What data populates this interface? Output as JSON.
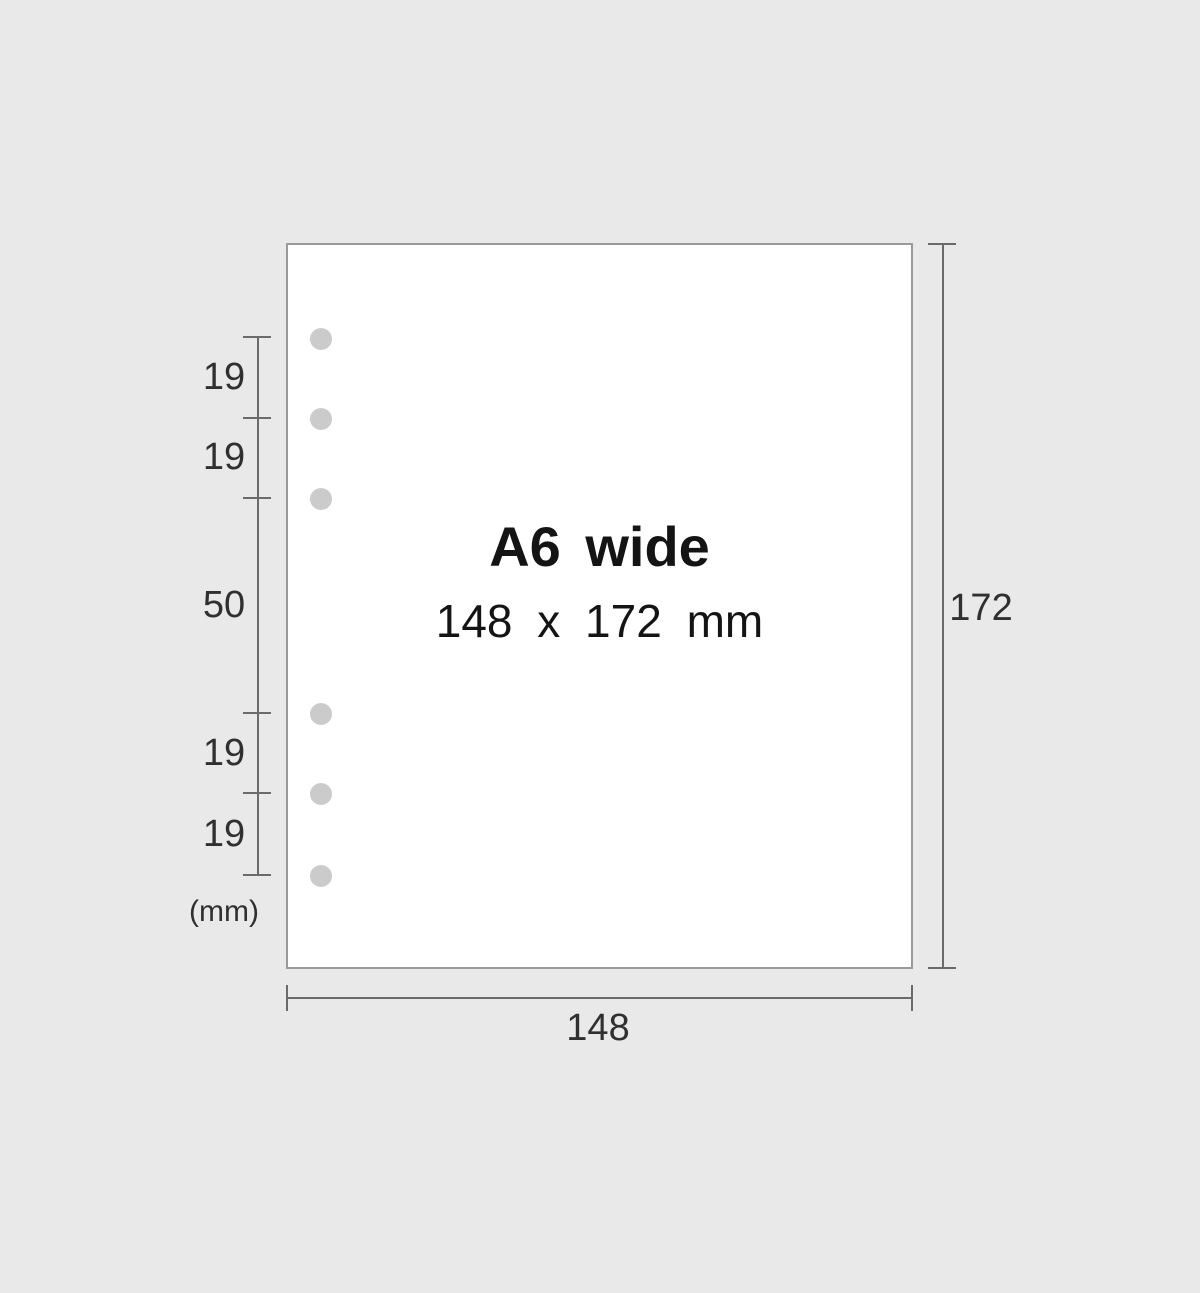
{
  "paper": {
    "title": "A6 wide",
    "size_label": "148 x 172 mm"
  },
  "holes": {
    "count": 6,
    "groups": "two groups of three holes"
  },
  "dimensions": {
    "left": {
      "labels": [
        "19",
        "19",
        "50",
        "19",
        "19"
      ],
      "unit": "(mm)"
    },
    "right": {
      "label": "172"
    },
    "bottom": {
      "label": "148"
    }
  },
  "colors": {
    "bg": "#e9e9e9",
    "paper_fill": "#ffffff",
    "paper_border": "#9a9a9a",
    "hole": "#cbcbcb",
    "dim_line": "#6a6a6a",
    "dim_text": "#303030",
    "title_text": "#141414"
  }
}
